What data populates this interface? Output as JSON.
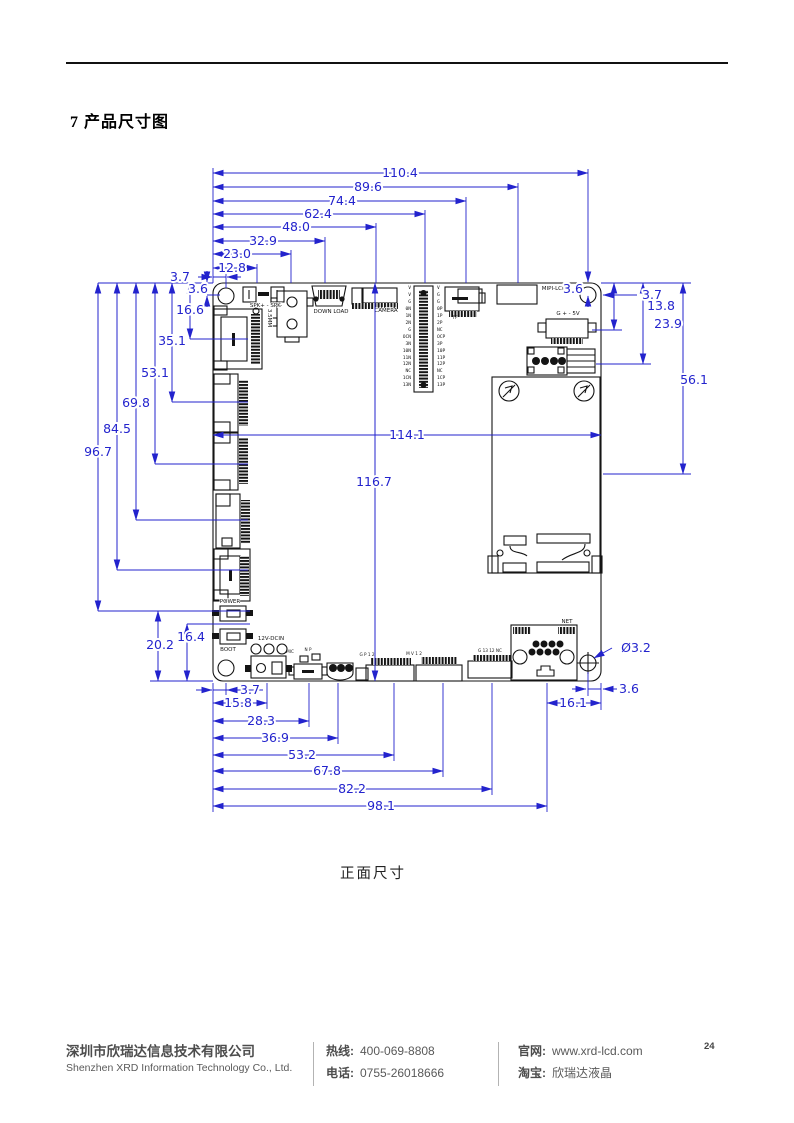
{
  "page": {
    "title": "7 产品尺寸图",
    "caption": "正面尺寸",
    "number": "24"
  },
  "footer": {
    "company_cn": "深圳市欣瑞达信息技术有限公司",
    "company_en": "Shenzhen XRD Information Technology Co., Ltd.",
    "hotline_label": "热线:",
    "hotline": "400-069-8808",
    "phone_label": "电话:",
    "phone": "0755-26018666",
    "web_label": "官网:",
    "web": "www.xrd-lcd.com",
    "taobao_label": "淘宝:",
    "taobao": "欣瑞达液晶"
  },
  "colors": {
    "dimension": "#2323cd",
    "line": "#141414"
  },
  "dims": {
    "top": [
      "110.4",
      "89.6",
      "74.4",
      "62.4",
      "48.0",
      "32.9",
      "23.0",
      "12.8"
    ],
    "tl_h": "3.7",
    "tl_v": "3.6",
    "left": [
      "16.6",
      "35.1",
      "53.1",
      "69.8",
      "84.5",
      "96.7"
    ],
    "bl": [
      "20.2",
      "16.4"
    ],
    "tr_v": "3.6",
    "tr_h": "3.7",
    "right": [
      "13.8",
      "23.9",
      "56.1"
    ],
    "width": "114.1",
    "height": "116.7",
    "bottom": [
      "3.7",
      "15.8",
      "28.3",
      "36.9",
      "53.2",
      "67.8",
      "82.2",
      "98.1"
    ],
    "br_w": "16.1",
    "br_h": "3.6",
    "hole": "Ø3.2"
  },
  "board": {
    "spk": "SPK+ - SPK-",
    "jack": "3.5MM",
    "download": "DOWN LOAD",
    "camera": "CAMERA",
    "mipi": "MIPI-LCD",
    "pwr5v": "G + - 5V",
    "tf": "TF",
    "power": "POWER",
    "boot": "BOOT",
    "dcin": "12V-DCIN",
    "mic": "MIC",
    "np": "N P",
    "net": "NET",
    "conn_a": "G P 1 2",
    "conn_b": "M V 1 2",
    "conn_c": "G 13 12 NC",
    "header_left": "V\nV\nG\n0N\n1N\n2N\nG\nOCN\n3N\n10N\n11N\n12N\nNC\n1CN\n13N",
    "header_right": "V\nG\nG\n0P\n1P\n2P\nNC\nOCP\n3P\n10P\n11P\n12P\nNC\n1CP\n13P"
  }
}
